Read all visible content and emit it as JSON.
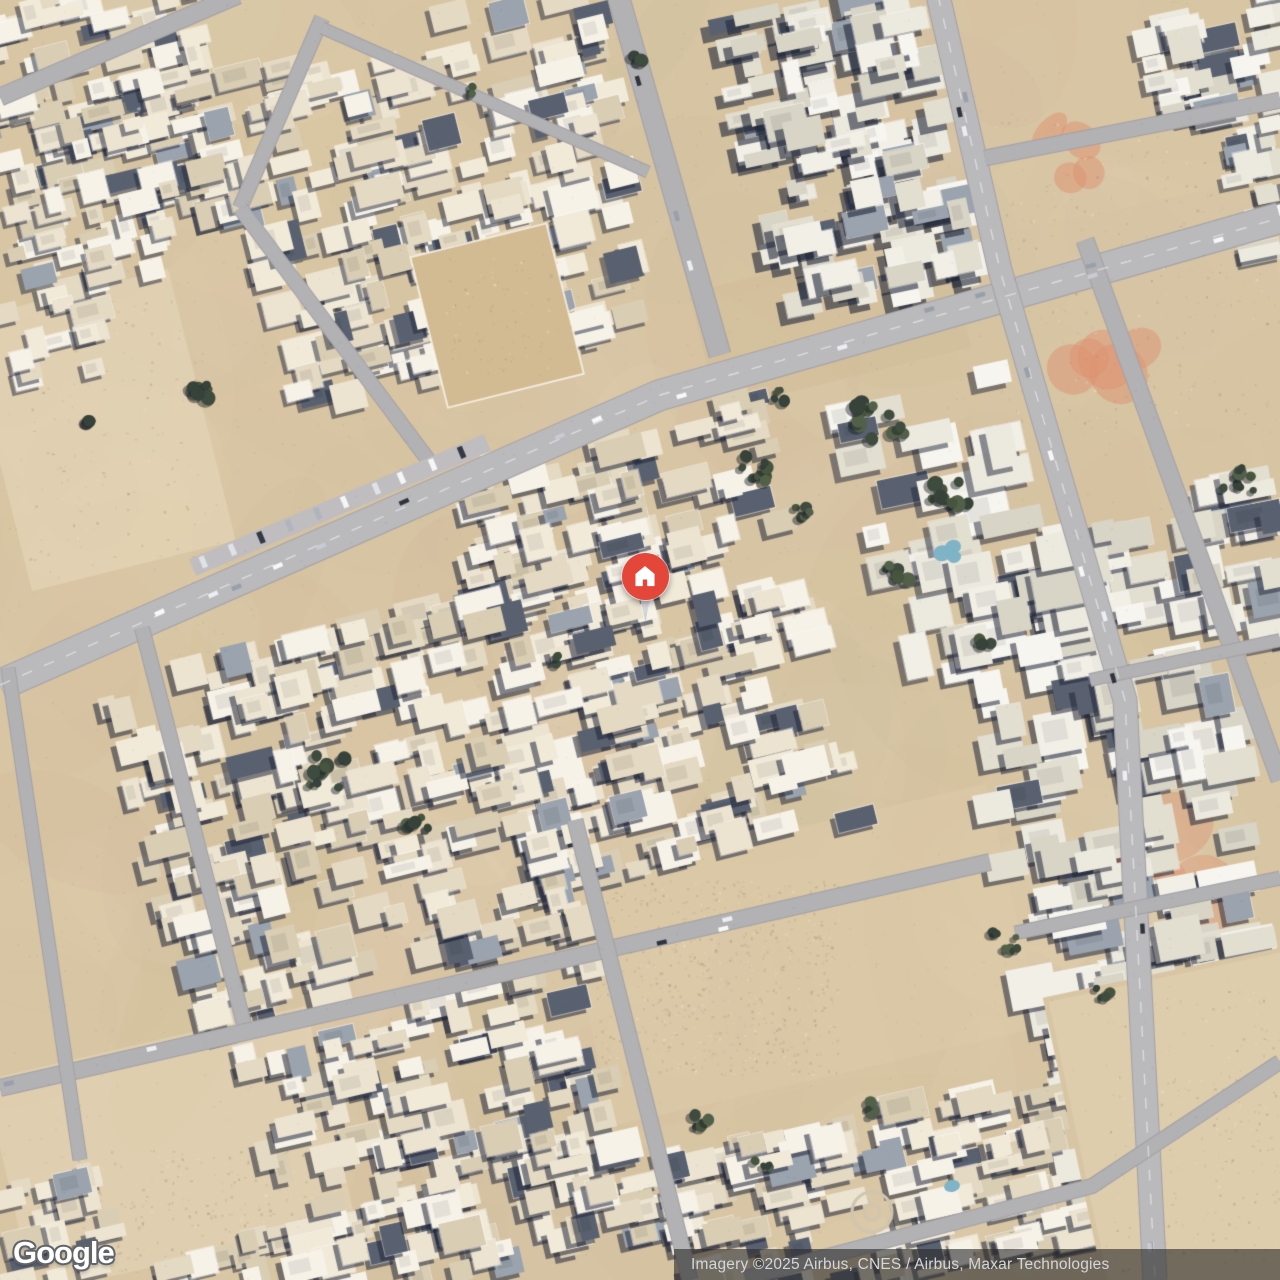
{
  "map": {
    "provider_logo": "Google",
    "attribution": "Imagery ©2025 Airbus, CNES / Airbus, Maxar Technologies",
    "marker": {
      "icon": "home-icon",
      "pin_color": "#E5463A",
      "tail_color": "#E7E8EA",
      "icon_color": "#FFFFFF",
      "x": 645,
      "y": 577
    }
  },
  "palette": {
    "sand_base": "#D8C5A3",
    "sand_light": "#E6D7BB",
    "sand_dark": "#C9B695",
    "dirt_salmon": "#DD9270",
    "road": "#B2B1B4",
    "road_main": "#BAB9BC",
    "road_edge": "#A2A1A4",
    "building_cream": "#ECE3D0",
    "building_white": "#F2EFE7",
    "shadow": "#202638",
    "tree": "#3E4B3F",
    "pool": "#7FB3C6",
    "attribution_bg": "rgba(40,40,40,0.60)",
    "attribution_text_color": "#D4D6D8",
    "logo_color": "#FFFFFF"
  }
}
